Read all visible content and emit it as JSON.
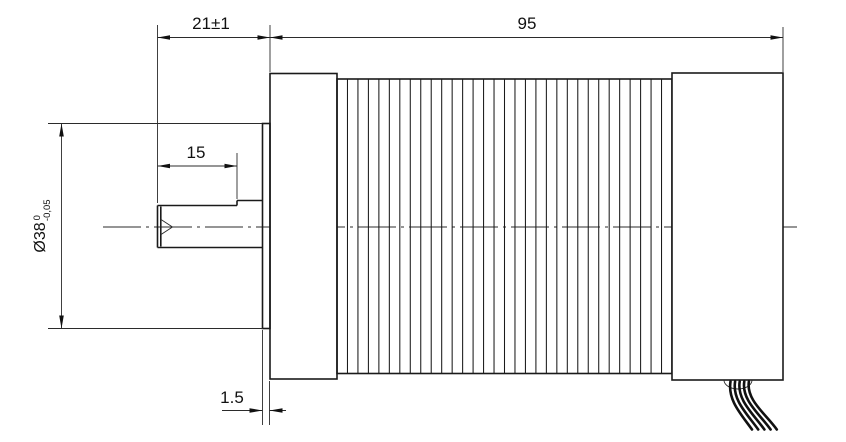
{
  "drawing": {
    "type": "engineering-dimension-drawing",
    "subject": "motor-side-view",
    "colors": {
      "background": "#ffffff",
      "line": "#1a1a1a"
    },
    "dimensions": {
      "shaft_overall_length": "21±1",
      "body_length": "95",
      "shaft_front_length": "15",
      "boss_diameter_main": "Ø38",
      "boss_diameter_tol_upper": "0",
      "boss_diameter_tol_lower": "-0,05",
      "boss_thickness": "1.5"
    },
    "fins": {
      "count": 31
    },
    "wires": {
      "count": 5
    }
  }
}
